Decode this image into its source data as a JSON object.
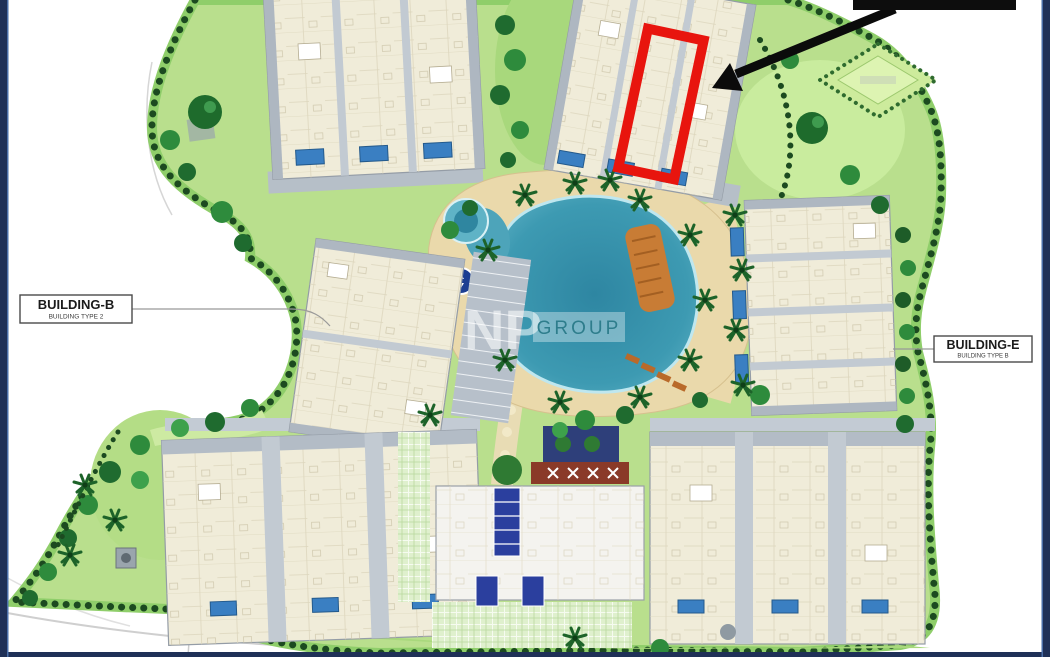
{
  "page": {
    "background": "#ffffff",
    "frame_color": "#1f3057"
  },
  "plan": {
    "labels": [
      {
        "id": "building-b",
        "title": "BUILDING-B",
        "subtitle": "BUILDING TYPE 2"
      },
      {
        "id": "building-e",
        "title": "BUILDING-E",
        "subtitle": "BUILDING TYPE B"
      }
    ],
    "watermark": {
      "primary": "NP",
      "secondary": "GROUP",
      "secondary_color": "#2e7d8c"
    },
    "annotations": {
      "highlight_color": "#e8150e",
      "arrow_color": "#0b0b0b",
      "redaction_bar_color": "#0d0d0d"
    },
    "palette": {
      "lawn": "#b9df8d",
      "hedge": "#1c4a20",
      "tree": "#2a7d36",
      "building": "#f0ecd9",
      "building_edge": "#aeb7c1",
      "lagoon_water": "#3d9ab2",
      "pool_deck": "#ead9ab",
      "unit_pool_blue": "#3a7fc2",
      "clubhouse_blue": "#2b3f9e",
      "sun_deck_orange": "#c87c35"
    }
  }
}
